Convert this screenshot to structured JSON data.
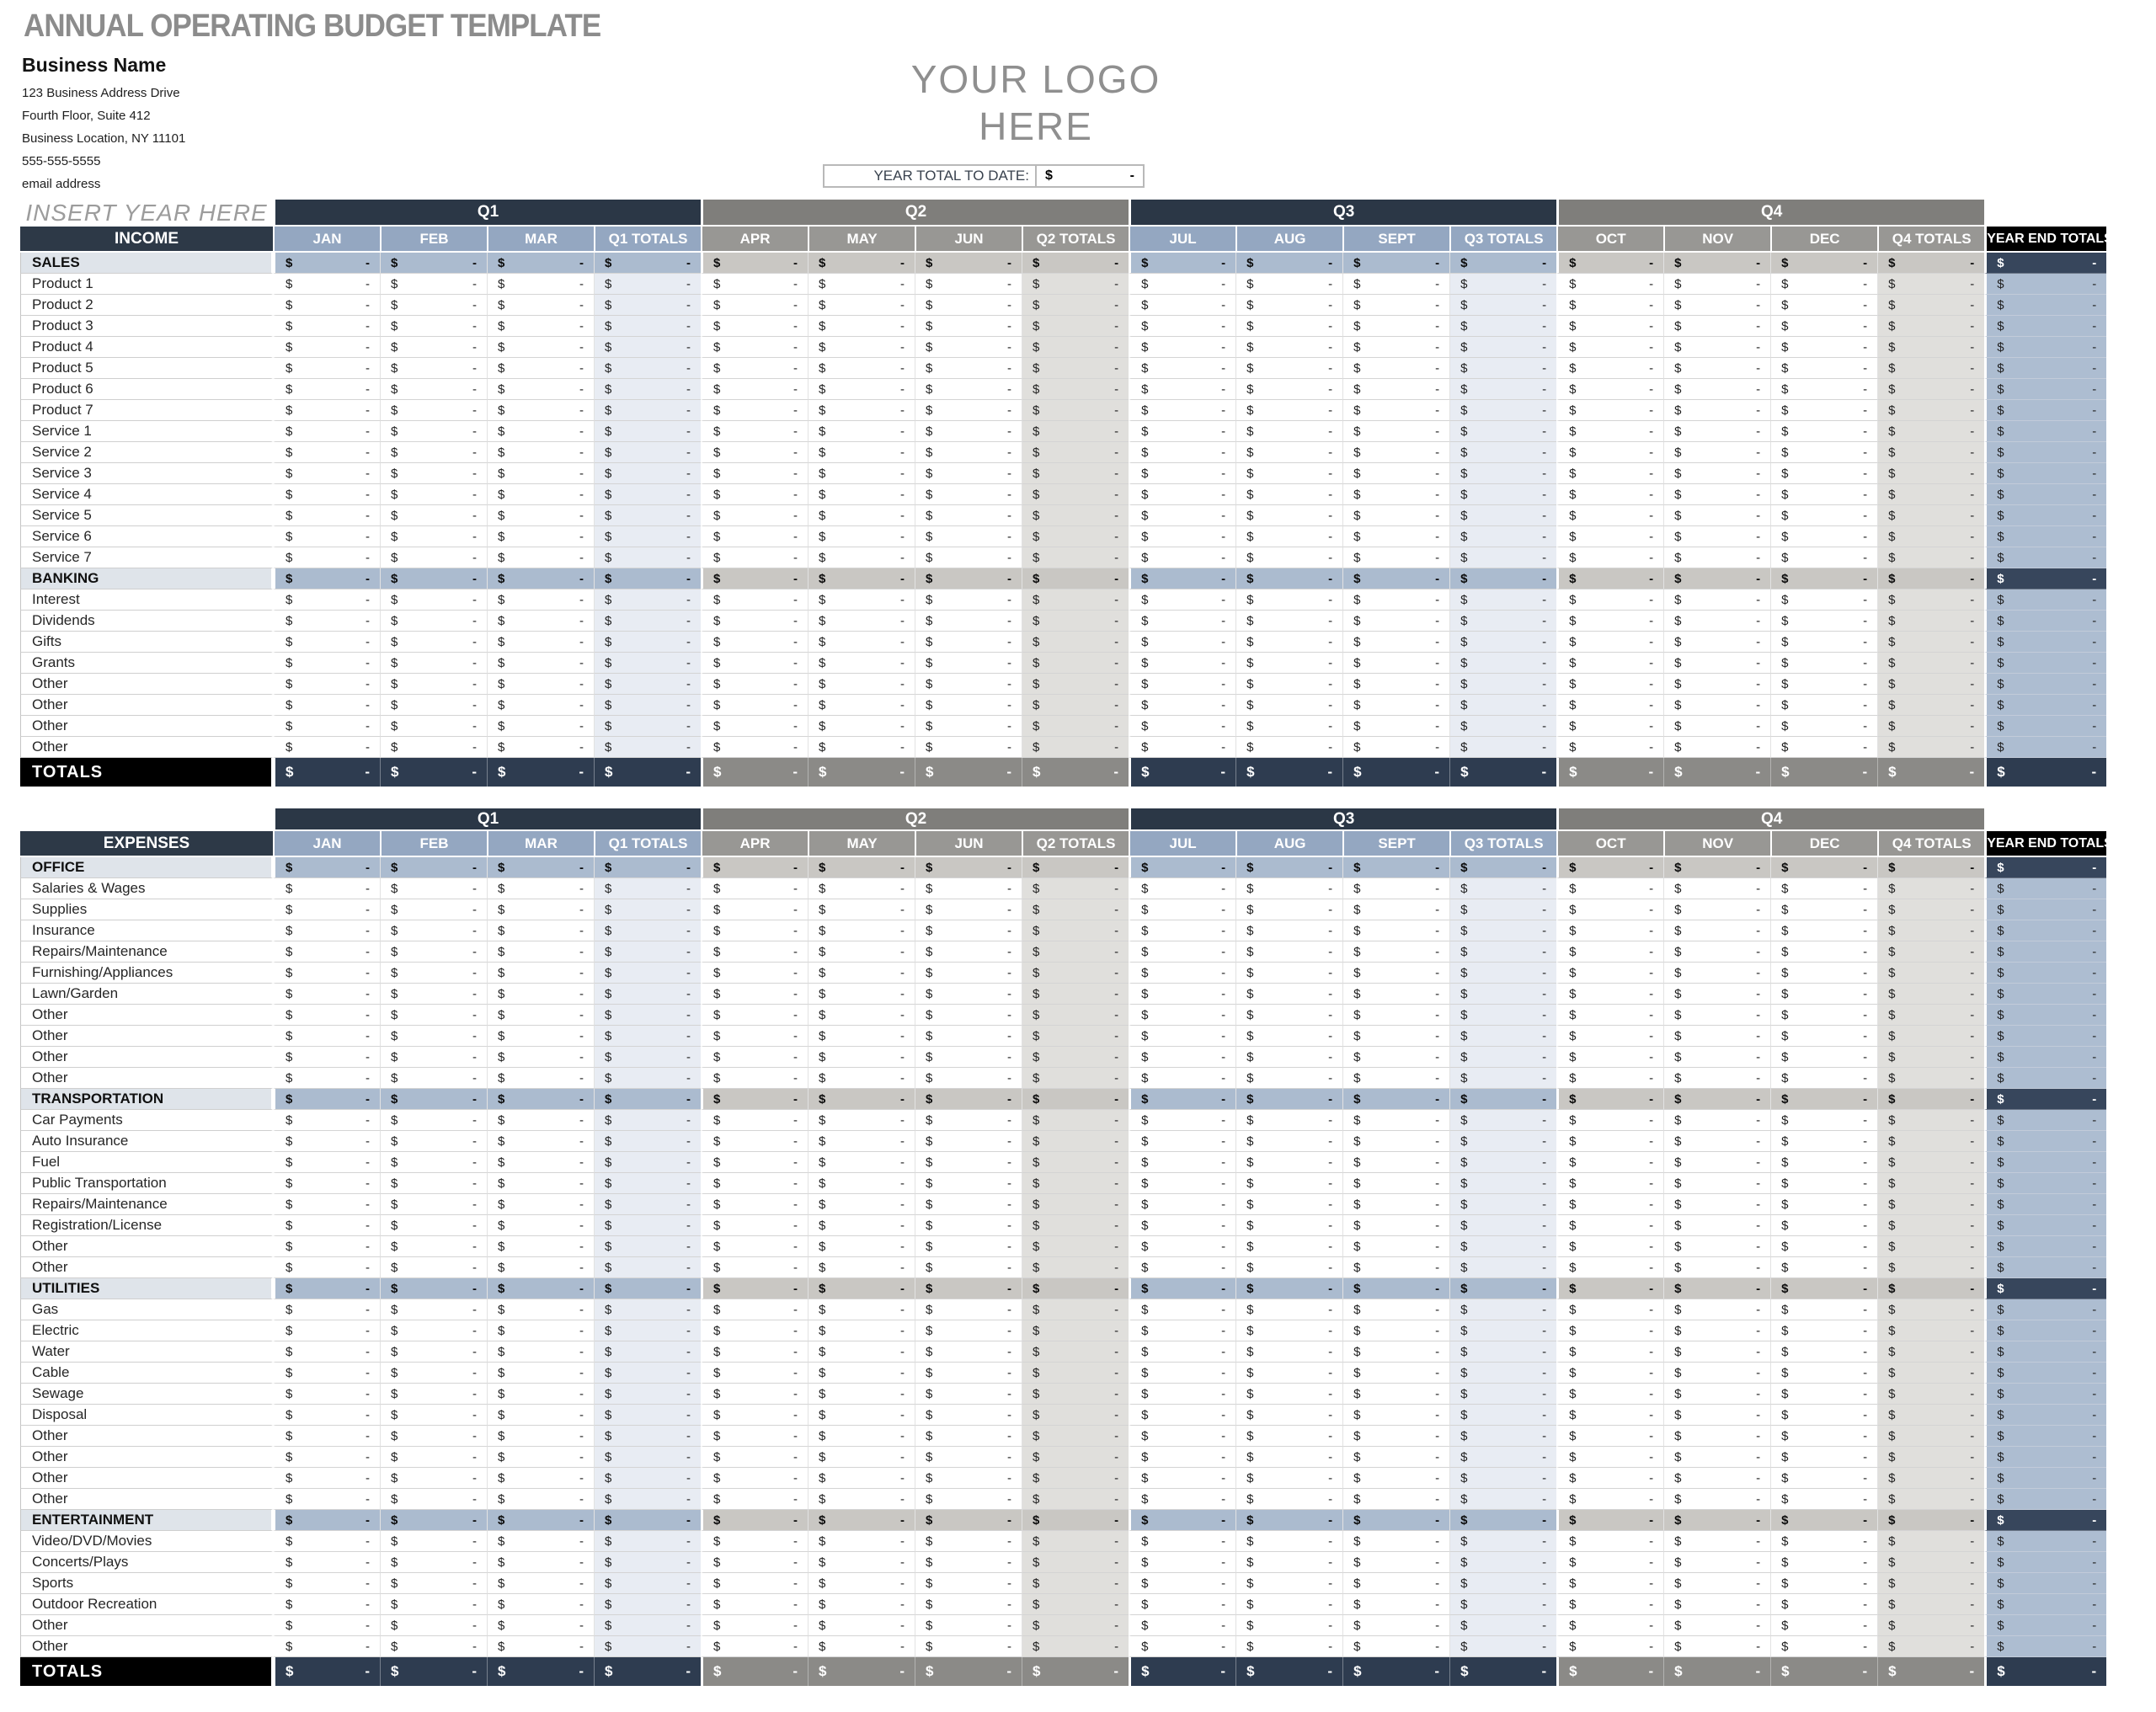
{
  "header": {
    "title": "ANNUAL OPERATING BUDGET TEMPLATE",
    "business_name": "Business Name",
    "address_lines": [
      "123 Business Address Drive",
      "Fourth Floor, Suite 412",
      "Business Location, NY  11101",
      "555-555-5555",
      "email address"
    ],
    "logo_lines": [
      "YOUR LOGO",
      "HERE"
    ],
    "year_total_label": "YEAR TOTAL TO DATE:"
  },
  "money_placeholder": {
    "currency": "$",
    "value": "-"
  },
  "columns": {
    "quarters": [
      {
        "label": "Q1",
        "scheme": "blue",
        "months": [
          "JAN",
          "FEB",
          "MAR"
        ],
        "total_label": "Q1 TOTALS"
      },
      {
        "label": "Q2",
        "scheme": "gray",
        "months": [
          "APR",
          "MAY",
          "JUN"
        ],
        "total_label": "Q2 TOTALS"
      },
      {
        "label": "Q3",
        "scheme": "blue",
        "months": [
          "JUL",
          "AUG",
          "SEPT"
        ],
        "total_label": "Q3 TOTALS"
      },
      {
        "label": "Q4",
        "scheme": "gray",
        "months": [
          "OCT",
          "NOV",
          "DEC"
        ],
        "total_label": "Q4 TOTALS"
      }
    ],
    "year_end_label": "YEAR END TOTALS"
  },
  "tables": [
    {
      "id": "income",
      "corner_note": "INSERT YEAR HERE",
      "label": "INCOME",
      "sections": [
        {
          "name": "SALES",
          "rows": [
            "Product 1",
            "Product 2",
            "Product 3",
            "Product 4",
            "Product 5",
            "Product 6",
            "Product 7",
            "Service 1",
            "Service 2",
            "Service 3",
            "Service 4",
            "Service 5",
            "Service 6",
            "Service 7"
          ]
        },
        {
          "name": "BANKING",
          "rows": [
            "Interest",
            "Dividends",
            "Gifts",
            "Grants",
            "Other",
            "Other",
            "Other",
            "Other"
          ]
        }
      ],
      "totals_label": "TOTALS"
    },
    {
      "id": "expenses",
      "corner_note": "",
      "label": "EXPENSES",
      "sections": [
        {
          "name": "OFFICE",
          "rows": [
            "Salaries & Wages",
            "Supplies",
            "Insurance",
            "Repairs/Maintenance",
            "Furnishing/Appliances",
            "Lawn/Garden",
            "Other",
            "Other",
            "Other",
            "Other"
          ]
        },
        {
          "name": "TRANSPORTATION",
          "rows": [
            "Car Payments",
            "Auto Insurance",
            "Fuel",
            "Public Transportation",
            "Repairs/Maintenance",
            "Registration/License",
            "Other",
            "Other"
          ]
        },
        {
          "name": "UTILITIES",
          "rows": [
            "Gas",
            "Electric",
            "Water",
            "Cable",
            "Sewage",
            "Disposal",
            "Other",
            "Other",
            "Other",
            "Other"
          ]
        },
        {
          "name": "ENTERTAINMENT",
          "rows": [
            "Video/DVD/Movies",
            "Concerts/Plays",
            "Sports",
            "Outdoor Recreation",
            "Other",
            "Other"
          ]
        }
      ],
      "totals_label": "TOTALS"
    }
  ],
  "colors": {
    "navy_band": "#2b3746",
    "gray_band": "#7f7e7b",
    "blue_month_header": "#94a7c1",
    "gray_month_header": "#989794",
    "section_blue_cell": "#abbbcf",
    "section_gray_cell": "#c9c7c3",
    "section_label_bg": "#dfe4ea",
    "qtotal_blue_tint": "#e8ecf3",
    "qtotal_gray_tint": "#e0dfdc",
    "year_end_cell": "#adbdd1",
    "year_end_section_cell": "#37465c",
    "totals_navy_cell": "#2e3c50",
    "totals_gray_cell": "#8b8a87",
    "black_header": "#000000",
    "title_gray": "#8c8c8c",
    "logo_gray": "#8f8f8f"
  }
}
